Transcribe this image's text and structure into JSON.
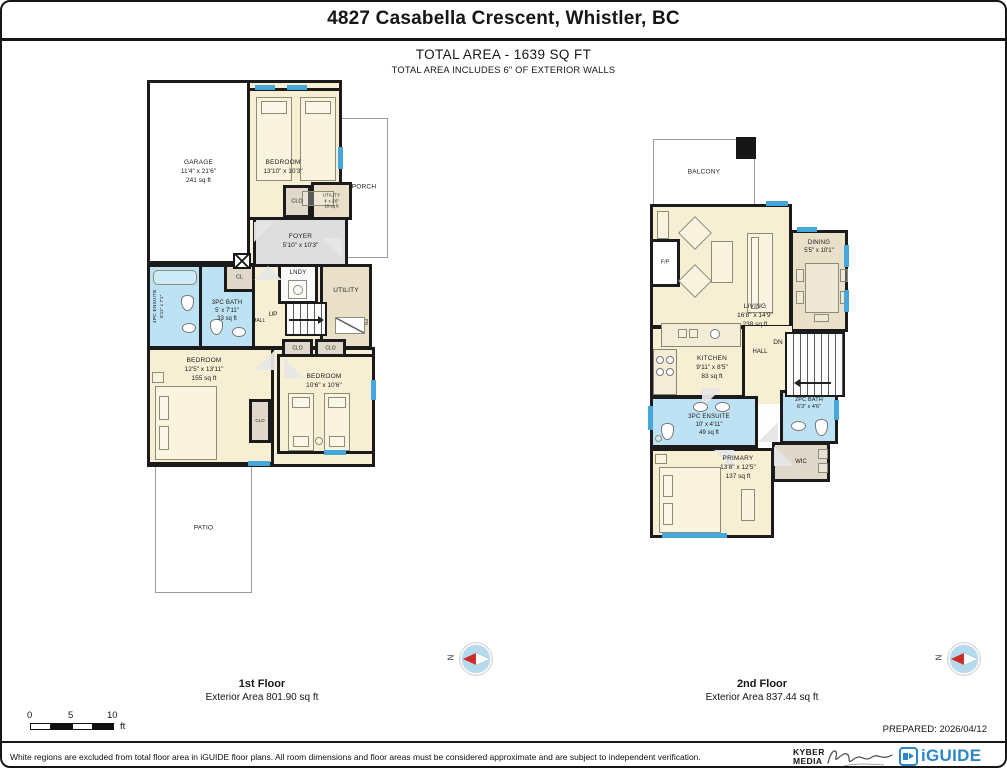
{
  "header": {
    "title": "4827 Casabella Crescent, Whistler, BC",
    "total_area": "TOTAL AREA - 1639 SQ FT",
    "total_area_note": "TOTAL AREA INCLUDES 6\" OF EXTERIOR WALLS"
  },
  "floor1": {
    "label": "1st Floor",
    "exterior_area": "Exterior Area 801.90 sq ft",
    "rooms": {
      "garage": {
        "name": "GARAGE",
        "dims": "11'4\" x 21'6\"",
        "area": "241 sq ft"
      },
      "bedroom_top": {
        "name": "BEDROOM",
        "dims": "13'10\" x 10'3\""
      },
      "porch": {
        "name": "PORCH"
      },
      "clo_top": {
        "name": "CLO"
      },
      "utility_top": {
        "name": "UTILITY",
        "dims": "4' x 2'6\"",
        "area": "10 sq ft"
      },
      "foyer": {
        "name": "FOYER",
        "dims": "5'10\" x 10'3\""
      },
      "lndy": {
        "name": "LNDY"
      },
      "utility_mid": {
        "name": "UTILITY"
      },
      "fn_label": "FN",
      "ensuite": {
        "name": "4PC ENSUITE",
        "dims": "5'11\" x 7'1\""
      },
      "bath": {
        "name": "3PC BATH",
        "dims": "5' x 7'11\"",
        "area": "33 sq ft"
      },
      "cl": {
        "name": "CL"
      },
      "hall": "HALL",
      "up": "UP",
      "clo_a": {
        "name": "CLO"
      },
      "clo_b": {
        "name": "CLO"
      },
      "clo_mid": {
        "name": "CLO"
      },
      "bedroom_left": {
        "name": "BEDROOM",
        "dims": "12'5\" x 13'11\"",
        "area": "155 sq ft"
      },
      "bedroom_right": {
        "name": "BEDROOM",
        "dims": "10'6\" x 10'6\""
      },
      "patio": {
        "name": "PATIO"
      }
    }
  },
  "floor2": {
    "label": "2nd Floor",
    "exterior_area": "Exterior Area 837.44 sq ft",
    "rooms": {
      "balcony": {
        "name": "BALCONY"
      },
      "living": {
        "name": "LIVING",
        "dims": "16'8\" x 14'9\"",
        "area": "238 sq ft"
      },
      "fp": {
        "name": "F/P"
      },
      "dining": {
        "name": "DINING",
        "dims": "5'5\" x 10'1\""
      },
      "kitchen": {
        "name": "KITCHEN",
        "dims": "9'11\" x 8'5\"",
        "area": "83 sq ft"
      },
      "hall": "HALL",
      "dn": "DN",
      "ensuite": {
        "name": "3PC ENSUITE",
        "dims": "10' x 4'11\"",
        "area": "49 sq ft"
      },
      "bath": {
        "name": "2PC BATH",
        "dims": "6'3\" x 4'6\""
      },
      "primary": {
        "name": "PRIMARY",
        "dims": "13'8\" x 12'5\"",
        "area": "137 sq ft"
      },
      "wic": {
        "name": "WIC"
      }
    }
  },
  "compass": {
    "n": "N"
  },
  "scale": {
    "zero": "0",
    "five": "5",
    "ten": "10",
    "unit": "ft"
  },
  "footer": {
    "prepared": "PREPARED: 2026/04/12",
    "disclaimer": "White regions are excluded from total floor area in iGUIDE floor plans. All room dimensions and floor areas must be considered approximate and are subject to independent verification.",
    "kyber_line1": "KYBER",
    "kyber_line2": "MEDIA",
    "iguide": "iGUIDE"
  },
  "colors": {
    "wall": "#1b1b1b",
    "room_cream": "#F7EFD4",
    "bathroom_blue": "#BCE2F3",
    "closet_tan": "#DFD8CB",
    "utility_tan": "#EADFC8",
    "foyer_gray": "#DEDEDE",
    "window_blue": "#46A7DC",
    "compass_red": "#CE2B26",
    "compass_fill": "#B5DAED",
    "iguide_blue": "#2E86C8"
  }
}
